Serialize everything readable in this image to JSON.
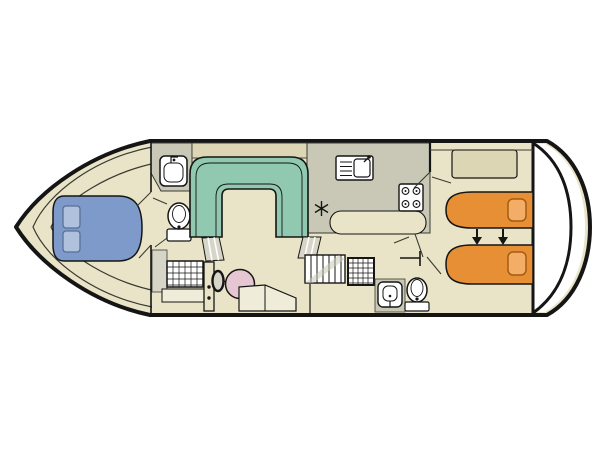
{
  "diagram": {
    "type": "boat-floorplan",
    "orientation": "bow-left-stern-right",
    "annotation_arrows": "two-down-arrows-beds-convert"
  },
  "colors": {
    "hull_interior": "#e9e4c7",
    "outline": "#151515",
    "wall_thin": "#3a3a32",
    "deck_white": "#ffffff",
    "panel_gray": "#c9c8b7",
    "cabinet_beige": "#dcd6b4",
    "step_gray": "#d6d5c7",
    "sofa_teal": "#90c8b0",
    "bed_blue": "#7d9aca",
    "pillow_blue": "#b0c1de",
    "pillow_blue_stroke": "#5a6f96",
    "bed_orange": "#e68f35",
    "pillow_orange": "#f3ad67",
    "pillow_orange_stroke": "#a35c10",
    "wheel_pink": "#e5c6d2",
    "fixture_white": "#ffffff",
    "bench_cream": "#efecd9"
  },
  "rooms": {
    "bow_cabin": {
      "furniture": [
        "double-bed",
        "pillow",
        "pillow"
      ]
    },
    "front_bathroom": {
      "fixtures": [
        "washbasin",
        "toilet",
        "shower-grid",
        "door-with-handle-dots"
      ]
    },
    "saloon": {
      "furniture": [
        "u-shaped-sofa",
        "sofa-step-left",
        "sofa-step-right",
        "helm-wheel",
        "helm-seat"
      ]
    },
    "galley": {
      "fixtures": [
        "sink-with-drainer",
        "hob-4-burners",
        "fridge-snowflake",
        "counter-peninsula"
      ]
    },
    "corridor": {
      "fixtures": [
        "stairs",
        "door-symbol"
      ]
    },
    "aft_bathroom": {
      "fixtures": [
        "shower-grid",
        "washbasin",
        "toilet"
      ]
    },
    "aft_cabin": {
      "furniture": [
        "wardrobe",
        "single-bed-top",
        "single-bed-bottom",
        "pillow",
        "pillow"
      ],
      "annotation": "beds-slide-together-arrows"
    },
    "stern_deck": {
      "features": [
        "double-curved-transom"
      ]
    }
  }
}
